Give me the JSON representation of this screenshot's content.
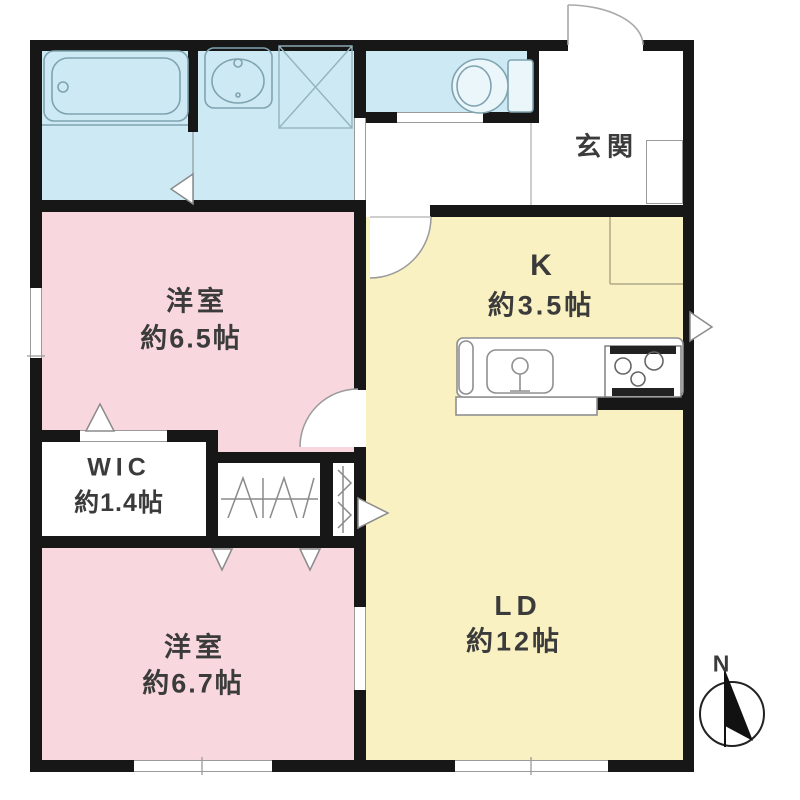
{
  "colors": {
    "wet": "#cdeaf4",
    "bedroom": "#f8d7de",
    "living": "#f9f1c2",
    "wall": "#171717",
    "label": "#3b3b3b"
  },
  "rooms": {
    "entrance": {
      "label": "玄関"
    },
    "kitchen": {
      "label": "K",
      "area": "約3.5帖"
    },
    "bedroom_65": {
      "label": "洋室",
      "area": "約6.5帖"
    },
    "wic": {
      "label": "WIC",
      "area": "約1.4帖"
    },
    "bedroom_67": {
      "label": "洋室",
      "area": "約6.7帖"
    },
    "living_dining": {
      "label": "LD",
      "area": "約12帖"
    }
  },
  "compass": {
    "label": "N"
  }
}
